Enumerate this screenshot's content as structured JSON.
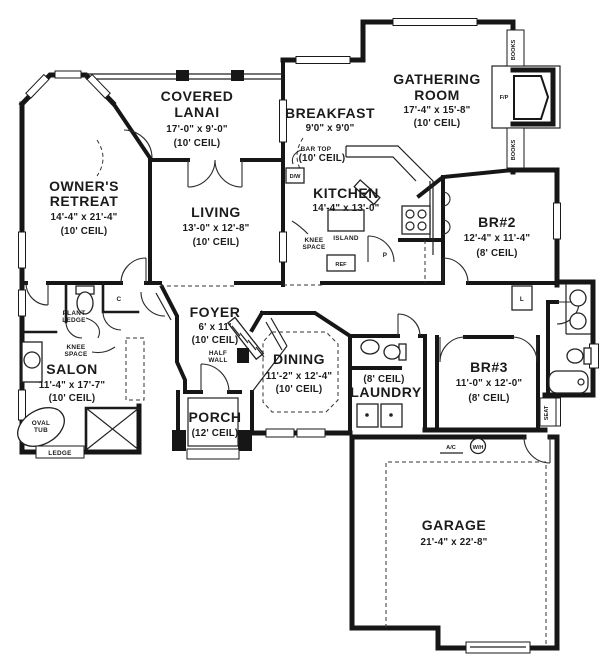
{
  "meta": {
    "title": "Floor plan",
    "ink_color": "#1b1b1b",
    "bg_color": "#ffffff"
  },
  "plan": {
    "rooms": {
      "lanai": {
        "lines": [
          "COVERED",
          "LANAI"
        ],
        "dims": "17'-0\" x 9'-0\"",
        "ceil": "(10' CEIL)"
      },
      "breakfast": {
        "name": "BREAKFAST",
        "dims": "9'0\" x 9'0\"",
        "ceil": "(10' CEIL)"
      },
      "gathering": {
        "lines": [
          "GATHERING",
          "ROOM"
        ],
        "dims": "17'-4\" x 15'-8\"",
        "ceil": "(10' CEIL)"
      },
      "owners": {
        "lines": [
          "OWNER'S",
          "RETREAT"
        ],
        "dims": "14'-4\" x 21'-4\"",
        "ceil": "(10' CEIL)"
      },
      "living": {
        "name": "LIVING",
        "dims": "13'-0\" x 12'-8\"",
        "ceil": "(10' CEIL)"
      },
      "kitchen": {
        "name": "KITCHEN",
        "dims": "14'-4\" x 13'-0\""
      },
      "br2": {
        "name": "BR#2",
        "dims": "12'-4\" x 11'-4\"",
        "ceil": "(8' CEIL)"
      },
      "foyer": {
        "name": "FOYER",
        "dims": "6' x 11'",
        "ceil": "(10' CEIL)"
      },
      "salon": {
        "name": "SALON",
        "dims": "11'-4\" x 17'-7\"",
        "ceil": "(10' CEIL)"
      },
      "dining": {
        "name": "DINING",
        "dims": "11'-2\" x 12'-4\"",
        "ceil": "(10' CEIL)"
      },
      "laundry": {
        "name": "LAUNDRY",
        "ceil": "(8' CEIL)"
      },
      "br3": {
        "name": "BR#3",
        "dims": "11'-0\" x 12'-0\"",
        "ceil": "(8' CEIL)"
      },
      "porch": {
        "name": "PORCH",
        "ceil": "(12' CEIL)"
      },
      "garage": {
        "name": "GARAGE",
        "dims": "21'-4\" x 22'-8\""
      }
    },
    "labels": {
      "plant_ledge": [
        "PLANT",
        "LEDGE"
      ],
      "knee_space_salon": [
        "KNEE",
        "SPACE"
      ],
      "knee_space_kitchen": [
        "KNEE",
        "SPACE"
      ],
      "oval_tub": [
        "OVAL",
        "TUB"
      ],
      "half_wall": [
        "HALF",
        "WALL"
      ],
      "ledge": "LEDGE",
      "bar_top": "BAR TOP",
      "dw": "D/W",
      "island": "ISLAND",
      "ref": "REF",
      "closet": "C",
      "pantry": "P",
      "linen": "L",
      "fireplace": "F/P",
      "books": "BOOKS",
      "seat": "SEAT",
      "ac": "A/C",
      "wh": "W/H"
    }
  }
}
